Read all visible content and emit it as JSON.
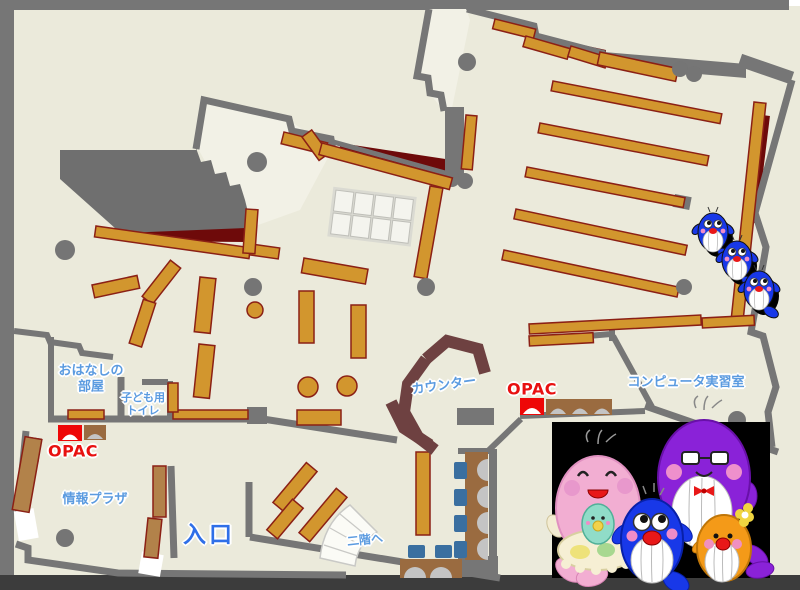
{
  "labels": {
    "story_room_line1": "おはなしの",
    "story_room_line2": "部屋",
    "kids_toilet_line1": "子ども用",
    "kids_toilet_line2": "トイレ",
    "opac_left": "OPAC",
    "opac_center": "OPAC",
    "info_plaza": "情報プラザ",
    "entrance": "入口",
    "counter": "カウンター",
    "computer_room": "コンピュータ実習室",
    "to_second_floor": "二階へ"
  },
  "colors": {
    "floor": "#ebeadb",
    "room_light": "#f2f1e6",
    "wall_gray": "#767676",
    "frame_bottom": "#3c3c3c",
    "shelf_orange": "#d2962e",
    "shelf_brown": "#b2824a",
    "shelf_outline": "#8b2015",
    "maroon_accent": "#6e0a0a",
    "counter_brown": "#6e4141",
    "desk_brown": "#9a6b40",
    "chair_blue": "#3a6fa0",
    "opac_red": "#ee0707",
    "label_blue": "#5b9be0",
    "label_red": "#e81010",
    "entrance_blue": "#2f6fe8"
  },
  "mascots": {
    "group": [
      "pink-whale",
      "baby-whale",
      "blue-whale",
      "purple-whale",
      "orange-whale"
    ],
    "climbers": [
      "small-blue-whale",
      "small-blue-whale",
      "small-blue-whale"
    ]
  }
}
